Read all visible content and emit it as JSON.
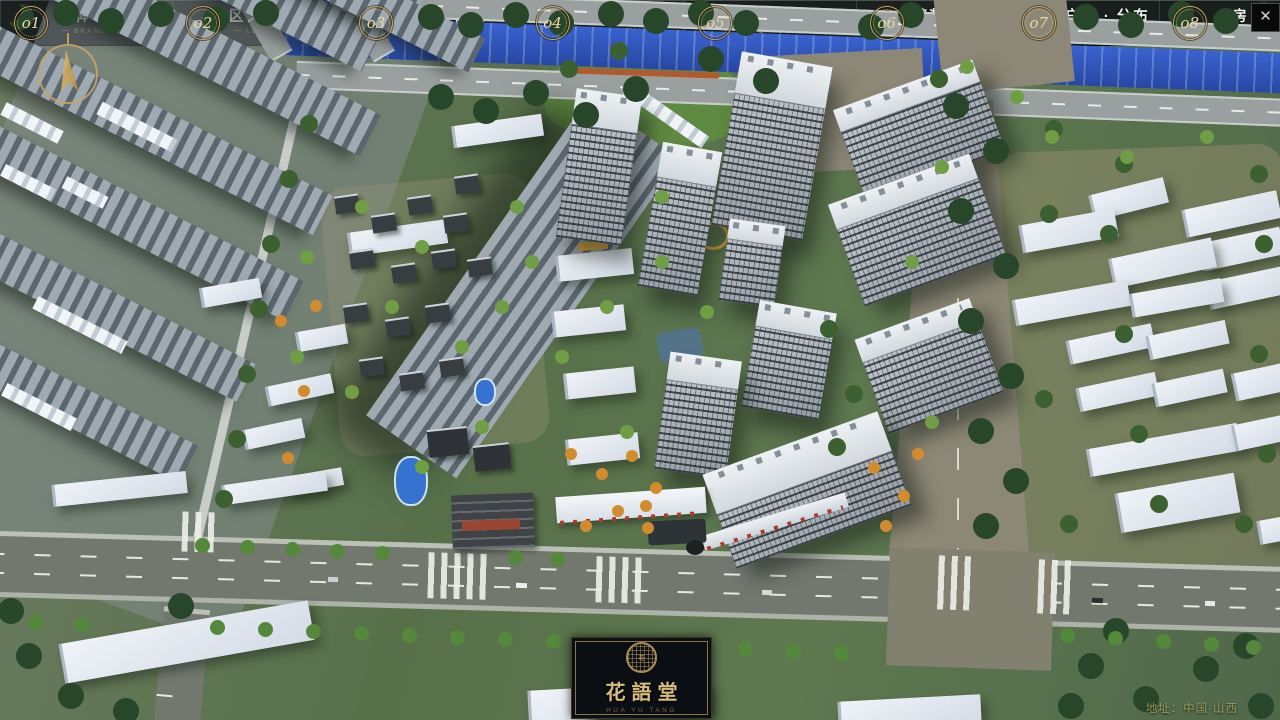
{
  "window": {
    "close_icon": "✕"
  },
  "icons": {
    "close": "close-x",
    "compass": "north-arrow-compass",
    "logo_seal": "round-seal-emblem"
  },
  "nav": {
    "items": [
      {
        "num": "o1",
        "zh": "品牌 · 介绍",
        "en": "BRAND SUPPORT"
      },
      {
        "num": "o2",
        "zh": "区位 · 价值",
        "en": "LOCATION VALUE"
      },
      {
        "num": "o3",
        "zh": "项目 · 概况",
        "en": "PROJECT SURVEY"
      },
      {
        "num": "o4",
        "zh": "建筑 · 鉴赏",
        "en": "APPRECIATION"
      },
      {
        "num": "o5",
        "zh": "园林 · 景观",
        "en": "GARDEN STREET"
      },
      {
        "num": "o6",
        "zh": "精装 · 体验",
        "en": "EXPERIENCE"
      },
      {
        "num": "o7",
        "zh": "户型 · 分布",
        "en": "SHOW ROOM"
      },
      {
        "num": "o8",
        "zh": "一房 · 一景",
        "en": "COMMUNITY"
      }
    ]
  },
  "logo": {
    "title": "花語堂",
    "seal_text": "花",
    "caption": "HUA YU TANG"
  },
  "footer": {
    "address": "地址：中国·山西"
  },
  "colors": {
    "gold": "#c9a766",
    "gold_dim": "#8f7b4a",
    "bar_bg": "rgba(14,17,21,0.86)",
    "river_blue": "#2b4fae",
    "road_grey": "#73786f",
    "tan_road": "#8c8776",
    "tree_green": "#3d6030",
    "building_white": "#e8ecf2",
    "logo_bg": "#0b0e12"
  }
}
